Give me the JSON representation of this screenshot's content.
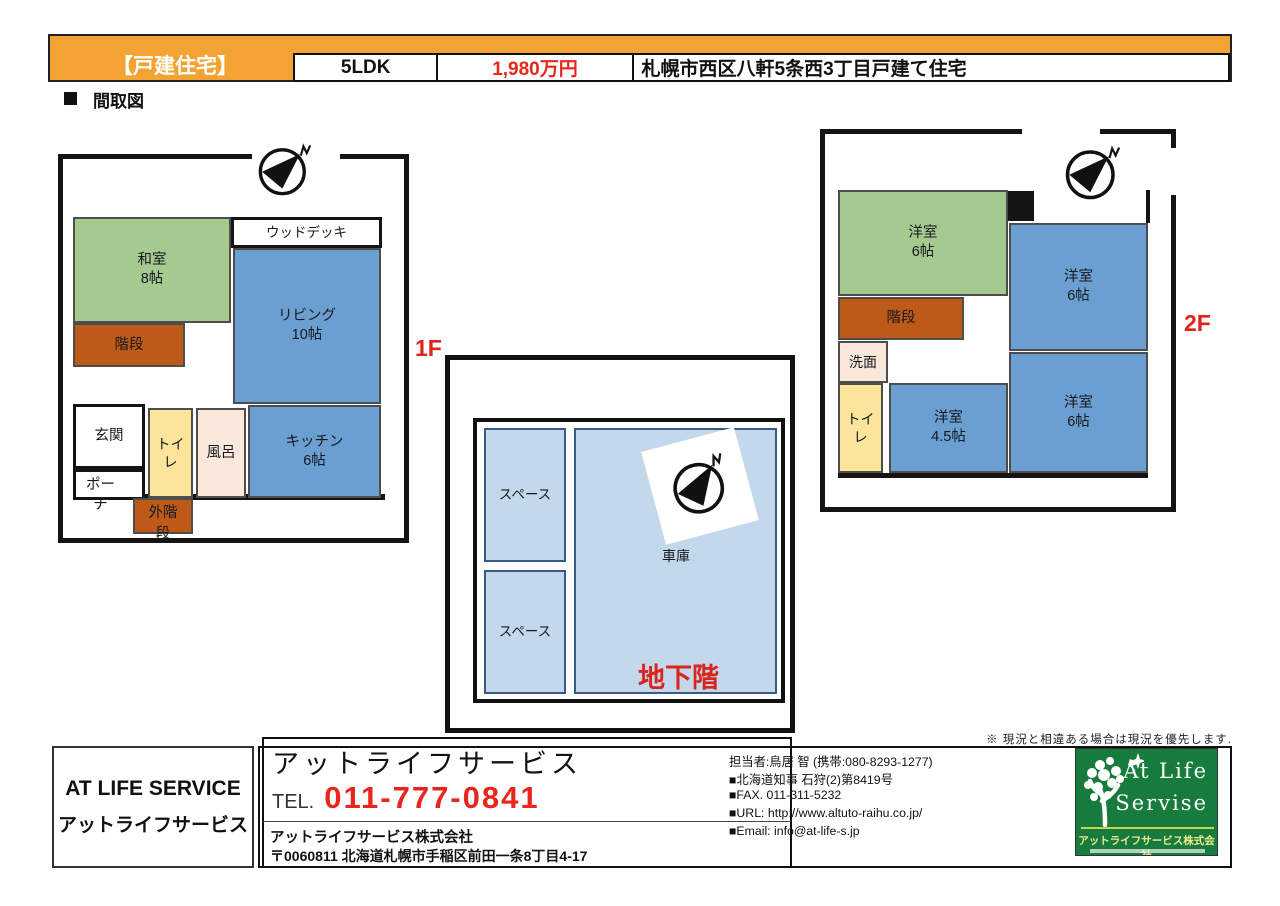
{
  "header": {
    "property_type": "【戸建住宅】",
    "layout": "5LDK",
    "price": "1,980万円",
    "title": "札幌市西区八軒5条西3丁目戸建て住宅",
    "section_label": "間取図"
  },
  "colors": {
    "header_orange": "#F2A333",
    "accent_red": "#E02318",
    "price_red": "#E8261D",
    "room_green": "#A6C98F",
    "room_blue": "#6B9FD2",
    "room_brown": "#BE5A17",
    "room_yellow": "#FCE49B",
    "room_pink": "#FAE8DC",
    "room_lightblue": "#C4D8EC",
    "logo_green": "#177B3D"
  },
  "floor1": {
    "label": "1F",
    "rooms": {
      "washitsu": "和室\n8帖",
      "wood_deck": "ウッドデッキ",
      "living": "リビング\n10帖",
      "stairs": "階段",
      "genkan": "玄関",
      "porch": "ポー\nチ",
      "toilet": "トイレ",
      "bath": "風呂",
      "kitchen": "キッチン\n6帖",
      "outer_stairs": "外階\n段"
    }
  },
  "basement": {
    "label": "地下階",
    "rooms": {
      "space1": "スペース",
      "space2": "スペース",
      "garage": "車庫"
    }
  },
  "floor2": {
    "label": "2F",
    "rooms": {
      "western_green": "洋室\n6帖",
      "western_top_right": "洋室\n6帖",
      "stairs": "階段",
      "senmen": "洗面",
      "toilet": "トイレ",
      "western_small": "洋室\n4.5帖",
      "western_bottom_right": "洋室\n6帖"
    }
  },
  "footer": {
    "note": "※ 現況と相違ある場合は現況を優先します.",
    "left_box": {
      "line1": "AT LIFE SERVICE",
      "line2": "アットライフサービス"
    },
    "tel_box": {
      "company": "アットライフサービス",
      "tel_label": "TEL.",
      "tel_number": "011-777-0841",
      "company_legal": "アットライフサービス株式会社",
      "address": "〒0060811 北海道札幌市手稲区前田一条8丁目4-17"
    },
    "contact": {
      "manager": "担当者:鳥居 智 (携帯:080-8293-1277)",
      "license": "■北海道知事  石狩(2)第8419号",
      "fax": "■FAX. 011-311-5232",
      "url": "■URL: http://www.altuto-raihu.co.jp/",
      "email": "■Email: info@at-life-s.jp"
    },
    "logo": {
      "name_line1": "At  Life",
      "name_line2": "Servise",
      "company": "アットライフサービス株式会社"
    }
  }
}
